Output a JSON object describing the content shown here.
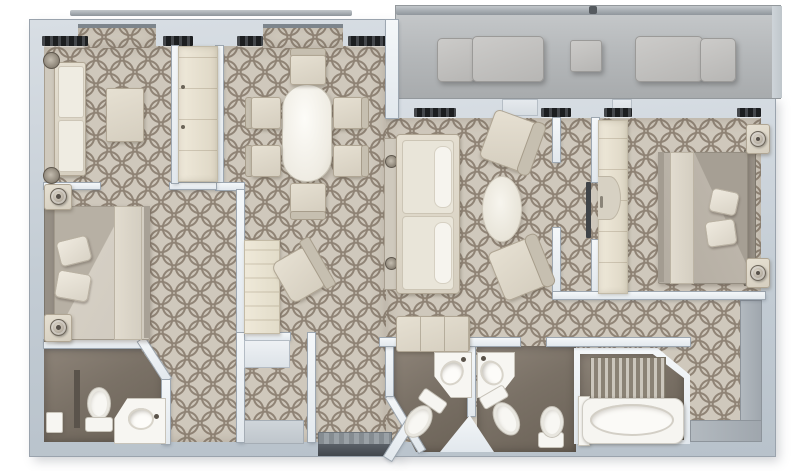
{
  "scene": {
    "type": "floor-plan",
    "description": "Top-down 3D rendered floor plan of a two-bedroom suite with central dining and living areas, four bath zones along the bottom, and a furnished balcony terrace across the top right"
  },
  "colors": {
    "page_background": "#ffffff",
    "outer_wall": "#c3ccd4",
    "inner_wall": "#f0f4f7",
    "carpet_base": "#cfc8bc",
    "carpet_pattern": "#8f8375",
    "bathroom_floor": "#7a7166",
    "balcony_floor": "#b4b7b9",
    "railing": "#8f969c",
    "furniture_cream": "#ddd6c8",
    "fixture_white": "#f7f6f2",
    "duvet_left_bed": "#cfc9be",
    "duvet_right_bed": "#b3aca1",
    "window_sill_dark": "#1c1e20",
    "entry_threshold": "#42474d"
  },
  "rooms": {
    "balcony": {
      "name": "balcony-terrace"
    },
    "sitting_area": {
      "name": "sitting-area"
    },
    "dining_area": {
      "name": "dining-area"
    },
    "living_area": {
      "name": "living-area"
    },
    "desk_nook": {
      "name": "desk-nook"
    },
    "bedroom_left": {
      "name": "left-bedroom"
    },
    "bedroom_right": {
      "name": "right-bedroom"
    },
    "bathroom_left": {
      "name": "left-bathroom"
    },
    "bathroom_a": {
      "name": "center-bathroom-1"
    },
    "bathroom_b": {
      "name": "center-bathroom-2"
    },
    "bathtub_room": {
      "name": "bathtub-room"
    },
    "vestibule": {
      "name": "closet-vestibule"
    },
    "entry": {
      "name": "entry-corridor"
    },
    "hallway": {
      "name": "bedroom-hallway"
    },
    "dressing": {
      "name": "dressing-corridor"
    }
  },
  "furniture": {
    "sitting_sofa": "two-seat sofa",
    "coffee_table": "coffee table",
    "dining_table": "oval dining table",
    "dining_chairs": "6 dining chairs",
    "living_sofa": "three-seat sofa with console",
    "armchairs": "2 angled armchairs",
    "pouf": "oval pouf",
    "bench": "bench",
    "desk": "writing desk",
    "desk_chair": "desk chair",
    "bed_left": "double bed with pillows and runner",
    "bed_right": "double bed with pillows and runner",
    "nightstands": "4 nightstands with round lamps",
    "toilets": "3 toilets",
    "bidet": "1 bidet",
    "sinks": "3 corner washbasins",
    "bathtub": "bathtub with slatted screen",
    "wardrobes": "2 lit wardrobe closets",
    "outdoor_sofas": "2 outdoor lounge sofas",
    "outdoor_table": "outdoor side table"
  }
}
